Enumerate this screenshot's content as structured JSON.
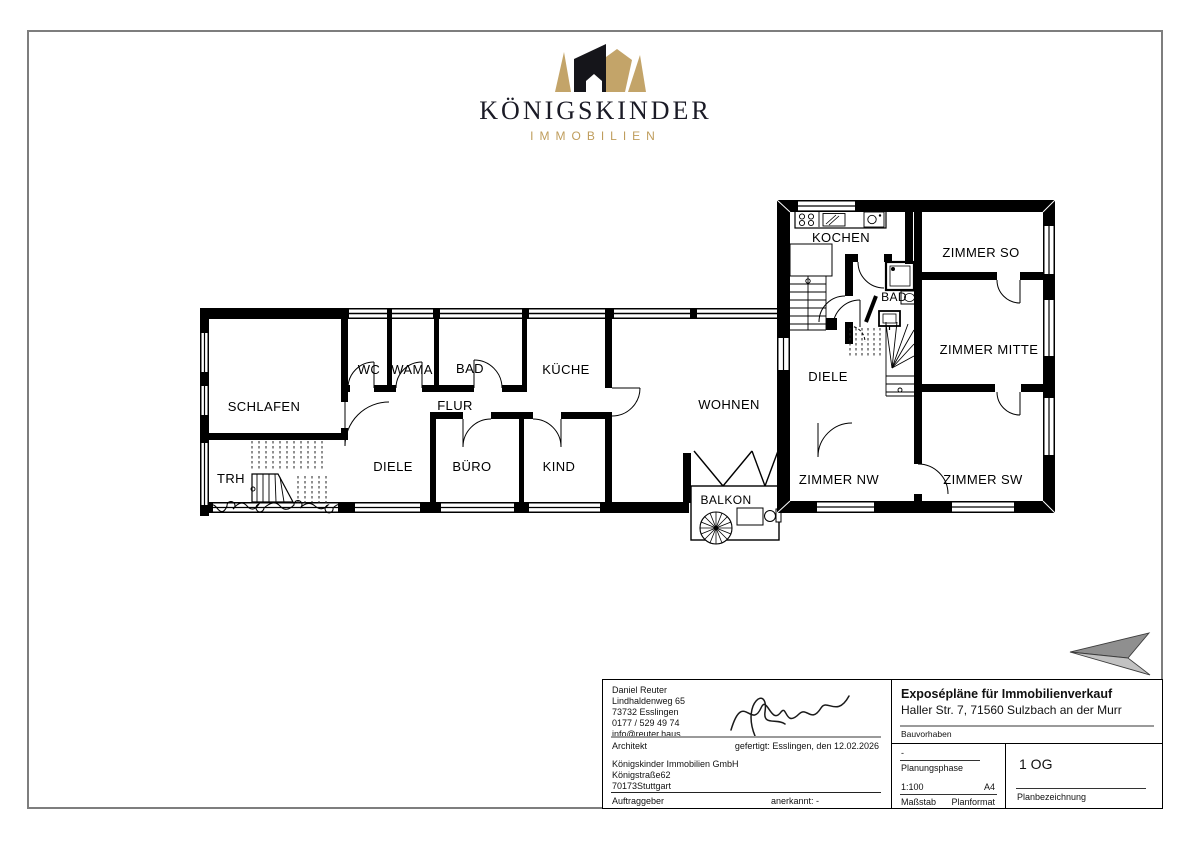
{
  "logo": {
    "title": "KÖNIGSKINDER",
    "subtitle": "IMMOBILIEN"
  },
  "colors": {
    "gold": "#c3a469",
    "logo_dark": "#15151a",
    "wall": "#000000",
    "arrow_dark": "#8f8f8f",
    "arrow_light": "#c2c2c2"
  },
  "rooms": {
    "schlafen": "SCHLAFEN",
    "wc": "WC",
    "wama": "WAMA",
    "bad_left": "BAD",
    "kueche": "KÜCHE",
    "flur": "FLUR",
    "diele_left": "DIELE",
    "buero": "BÜRO",
    "kind": "KIND",
    "wohnen": "WOHNEN",
    "trh": "TRH",
    "balkon": "BALKON",
    "kochen": "KOCHEN",
    "bad_right": "BAD",
    "zimmer_so": "ZIMMER SO",
    "zimmer_mitte": "ZIMMER MITTE",
    "diele_right": "DIELE",
    "zimmer_nw": "ZIMMER NW",
    "zimmer_sw": "ZIMMER SW"
  },
  "title_block": {
    "architect_name": "Daniel Reuter",
    "architect_street": "Lindhaldenweg 65",
    "architect_city": "73732 Esslingen",
    "architect_phone": "0177 / 529 49 74",
    "architect_email": "info@reuter.haus",
    "architect_label": "Architekt",
    "prepared_note": "gefertigt: Esslingen, den 12.02.2026",
    "client_name": "Königskinder Immobilien GmbH",
    "client_street": "Königstraße62",
    "client_city": "70173Stuttgart",
    "client_label": "Auftraggeber",
    "approved_note": "anerkannt: -",
    "project_title": "Exposépläne für Immobilienverkauf",
    "project_address": "Haller Str. 7, 71560 Sulzbach an der Murr",
    "project_label": "Bauvorhaben",
    "phase_value": "-",
    "phase_label": "Planungsphase",
    "scale_value": "1:100",
    "scale_label": "Maßstab",
    "format_value": "A4",
    "format_label": "Planformat",
    "plan_value": "1 OG",
    "plan_label": "Planbezeichnung"
  }
}
